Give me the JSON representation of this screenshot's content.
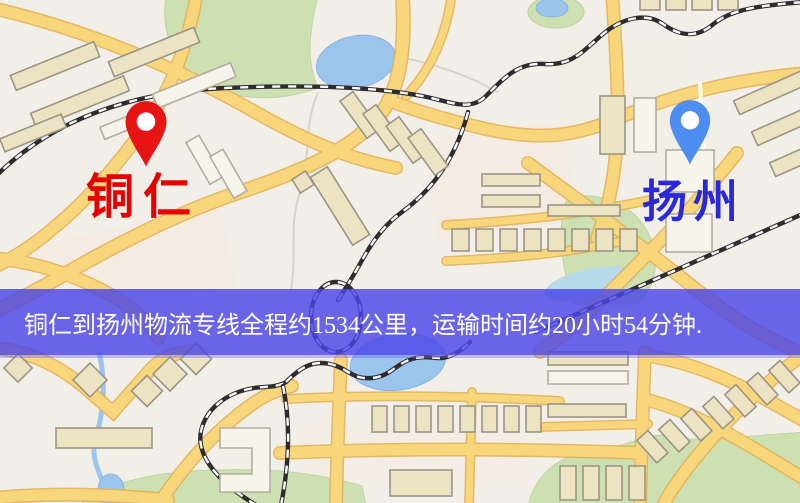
{
  "markers": {
    "origin": {
      "label": "铜仁",
      "pin_color": "#e81414",
      "label_color": "#e60000"
    },
    "destination": {
      "label": "扬州",
      "pin_color": "#4d8df2",
      "label_color": "#2a28d8"
    }
  },
  "banner": {
    "text": "铜仁到扬州物流专线全程约1534公里，运输时间约20小时54分钟.",
    "route": {
      "origin": "铜仁",
      "destination": "扬州",
      "service": "物流专线",
      "distance_km": "1534",
      "duration": "20小时54分钟"
    },
    "background_color": "#4b46e8",
    "text_color": "#ffffff"
  },
  "map": {
    "type": "street-map",
    "colors": {
      "background": "#f2efe9",
      "road": "#f8d77c",
      "railway": "#2e2c2e",
      "park": "#cde0b2",
      "water": "#9cc5ee"
    }
  }
}
